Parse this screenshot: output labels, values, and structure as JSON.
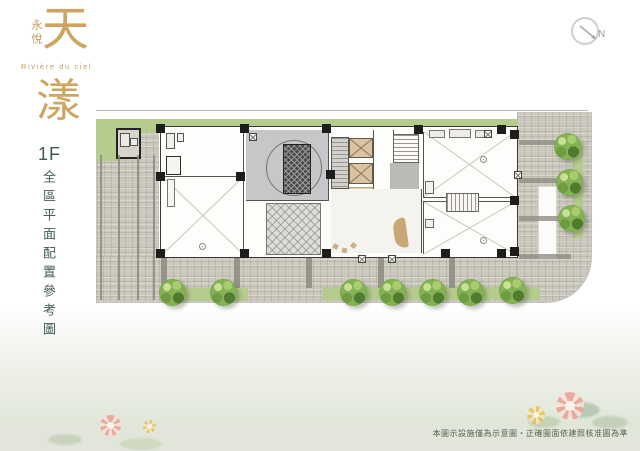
{
  "brand": {
    "company": "永悅",
    "name_char_1": "天",
    "name_char_2": "漾",
    "tagline": "Rivière du ciel"
  },
  "plan_info": {
    "floor_label": "1F",
    "title": "全區平面配置參考圖"
  },
  "compass": {
    "north_label": "N"
  },
  "footer": {
    "disclaimer": "本圖示設施僅為示意圖‧正確圖面依建照核准圖為準"
  },
  "colors": {
    "brand_gold": "#cda563",
    "title_teal": "#3f5c55",
    "grass_green": "#b6cc8e",
    "tree_green": "#7fae4e",
    "paver_gray": "#cbc8be",
    "wall_black": "#3a3a36",
    "elevator_tan": "#d9c3a0"
  }
}
